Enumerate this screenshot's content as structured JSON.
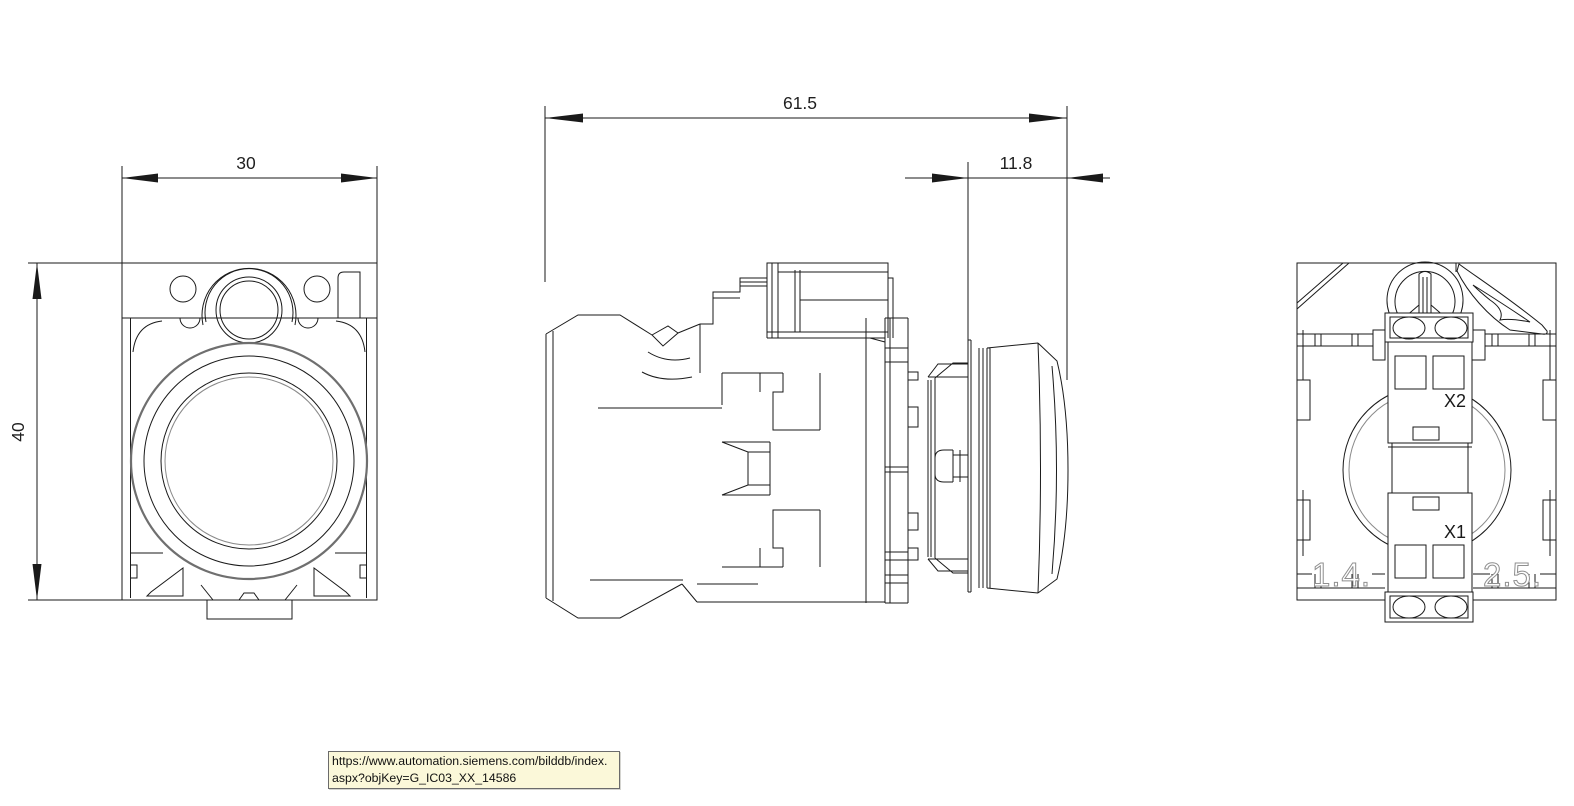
{
  "colors": {
    "line": "#1a1a1a",
    "thick_arc": "#6f6f6f",
    "engraved_marking": "#8f8f8f",
    "tooltip_background": "#fbf8d9",
    "tooltip_border": "#6b6b6b"
  },
  "dimensions": {
    "front_width": "30",
    "front_height": "40",
    "total_depth": "61.5",
    "head_depth": "11.8"
  },
  "rear": {
    "terminal_x2": "X2",
    "terminal_x1": "X1",
    "marking_left": "1.4.",
    "marking_right": "2.5."
  },
  "tooltip": {
    "line1": "https://www.automation.siemens.com/bilddb/index.",
    "line2": "aspx?objKey=G_IC03_XX_14586"
  }
}
